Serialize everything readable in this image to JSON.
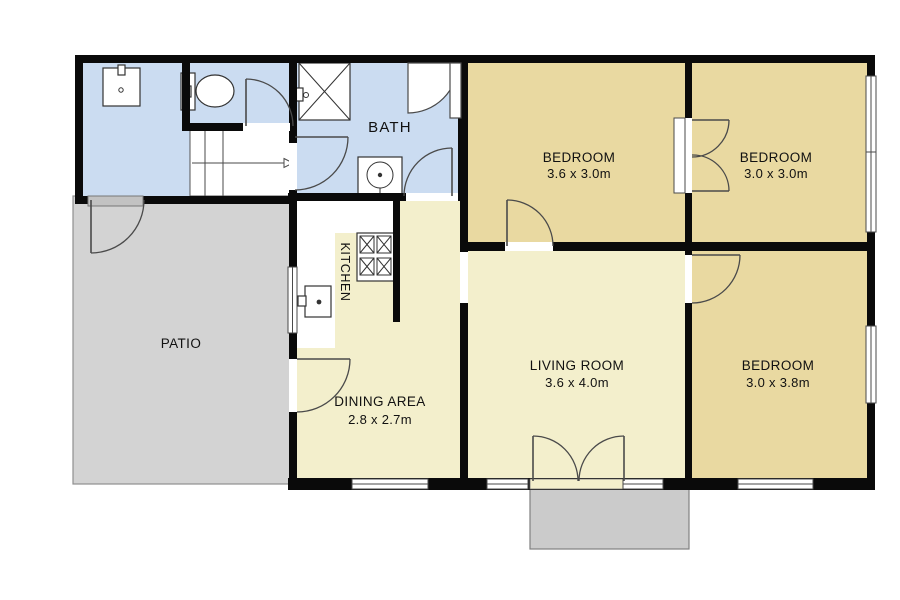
{
  "plan_title": "single-storey house floor plan",
  "rooms": {
    "bath": {
      "label": "BATH"
    },
    "bedroom1": {
      "label": "BEDROOM",
      "dimensions": "3.6 x 3.0m"
    },
    "bedroom2": {
      "label": "BEDROOM",
      "dimensions": "3.0 x 3.0m"
    },
    "bedroom3": {
      "label": "BEDROOM",
      "dimensions": "3.0 x 3.8m"
    },
    "living_room": {
      "label": "LIVING ROOM",
      "dimensions": "3.6 x 4.0m"
    },
    "dining_area": {
      "label": "DINING AREA",
      "dimensions": "2.8 x 2.7m"
    },
    "kitchen": {
      "label": "KITCHEN"
    },
    "patio": {
      "label": "PATIO"
    }
  },
  "fixtures": [
    "laundry-sink",
    "toilet",
    "shower",
    "washing-machine",
    "staircase",
    "stove",
    "kitchen-sink"
  ],
  "colors": {
    "wall": "#0a0a0a",
    "bath_floor": "#cbdcf1",
    "bedroom_floor": "#e9d9a1",
    "living_floor": "#f3efcc",
    "kitchen_floor": "#ffffff",
    "patio": "#d3d3d3",
    "porch": "#cbcbcb",
    "door_step": "#c2c2c2",
    "door_stroke": "#4a4a4a"
  }
}
